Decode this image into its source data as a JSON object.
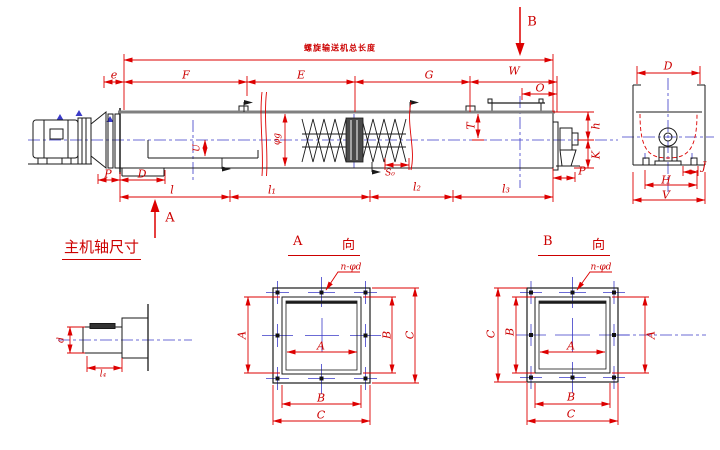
{
  "annotation_colors": {
    "dimension_red": "#dd0000",
    "centerline_blue": "#3b3bc8",
    "line_black": "#1a1a1a"
  },
  "main_view": {
    "overall_note": "螺旋输送机总长度",
    "top_dims": {
      "e": "e",
      "F": "F",
      "E": "E",
      "G": "G",
      "W": "W",
      "O": "O"
    },
    "body_dims": {
      "T": "T",
      "phi": "φg",
      "U": "U",
      "S0": "S₀",
      "h": "h",
      "K": "K"
    },
    "bottom_dims": {
      "P_left": "P",
      "D": "D",
      "l": "l",
      "l1": "l₁",
      "l2": "l₂",
      "l3": "l₃",
      "P_right": "P"
    },
    "view_arrows": {
      "A": "A",
      "B": "B"
    }
  },
  "end_view": {
    "dims": {
      "D": "D",
      "J": "J",
      "H": "H",
      "V": "V"
    }
  },
  "shaft_detail": {
    "title": "主机轴尺寸",
    "dims": {
      "d": "d",
      "l4": "l₄"
    }
  },
  "view_A": {
    "title_letter": "A",
    "title_suffix": "向",
    "bolt_pattern": "n-φd",
    "dims": {
      "inner_A": "A",
      "left_A": "A",
      "right_B": "B",
      "right_C": "C",
      "bottom_B": "B",
      "bottom_C": "C"
    }
  },
  "view_B": {
    "title_letter": "B",
    "title_suffix": "向",
    "bolt_pattern": "n-φd",
    "dims": {
      "inner_A": "A",
      "left_B": "B",
      "left_C": "C",
      "right_A": "A",
      "bottom_B": "B",
      "bottom_C": "C"
    }
  }
}
